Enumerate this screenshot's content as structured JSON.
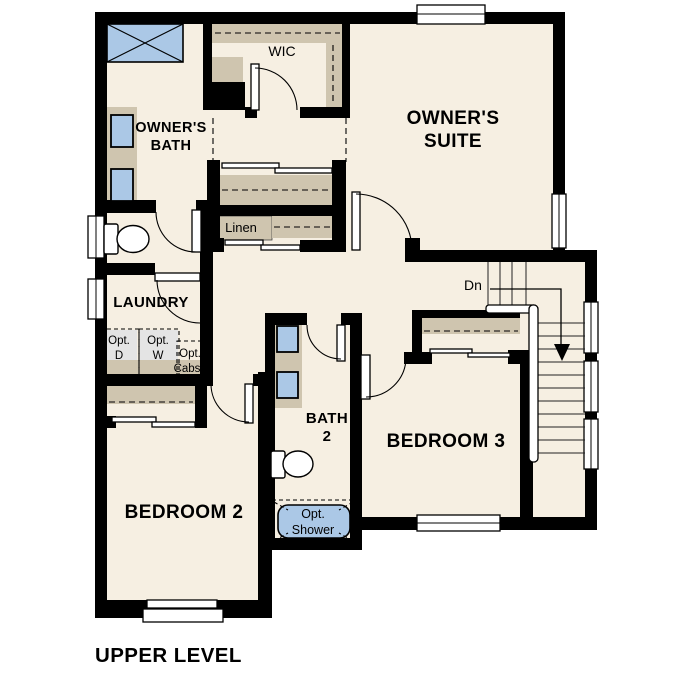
{
  "title": {
    "label": "UPPER LEVEL"
  },
  "rooms": {
    "owners_suite": {
      "line1": "OWNER'S",
      "line2": "SUITE"
    },
    "owners_bath": {
      "line1": "OWNER'S",
      "line2": "BATH"
    },
    "wic": {
      "label": "WIC"
    },
    "laundry": {
      "label": "LAUNDRY"
    },
    "linen": {
      "label": "Linen"
    },
    "bath2": {
      "line1": "BATH",
      "line2": "2"
    },
    "bedroom2": {
      "label": "BEDROOM 2"
    },
    "bedroom3": {
      "label": "BEDROOM 3"
    }
  },
  "options": {
    "dryer": {
      "line1": "Opt.",
      "line2": "D"
    },
    "washer": {
      "line1": "Opt.",
      "line2": "W"
    },
    "cabinets": {
      "line1": "Opt.",
      "line2": "Cabs"
    },
    "shower": {
      "line1": "Opt.",
      "line2": "Shower"
    }
  },
  "stairs": {
    "down_label": "Dn"
  },
  "colors": {
    "floor": "#f6efe2",
    "wall": "#000000",
    "cabinet": "#cfc5af",
    "fixture_blue": "#abc8e6",
    "appliance_gray": "#e4e4e4",
    "page_bg": "#ffffff"
  }
}
